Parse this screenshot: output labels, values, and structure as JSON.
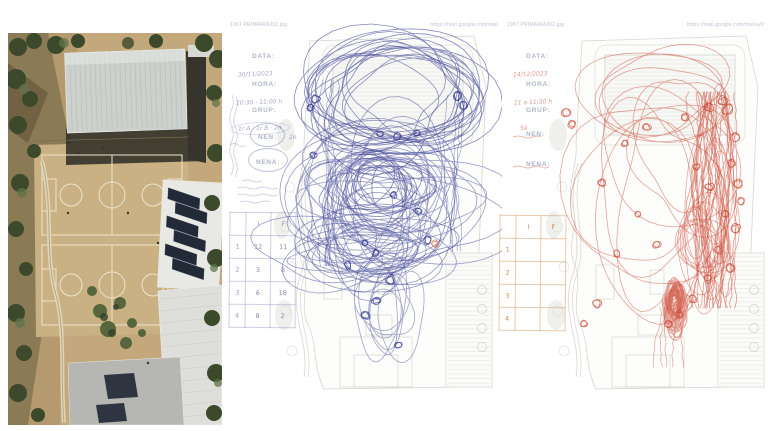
{
  "pages": {
    "blue": {
      "header_left": "1967 PRIMARIA302.jpg",
      "header_right": "https://mail.google.com/mail",
      "ink": "#353b90",
      "form": {
        "data_label": "DATA:",
        "data_value": "30/11/2023",
        "hora_label": "HORA:",
        "hora_value": "10:30 - 11:00 h",
        "grup_label": "GRUP:",
        "grup_value": "1r A · 1r B · 2n",
        "nen_label": "NEN:",
        "nen_value": "2n",
        "nena_label": "NENA:",
        "nena_value": ""
      },
      "table": {
        "col_i": "I",
        "col_f": "F",
        "rows": [
          [
            "1",
            "12",
            "11"
          ],
          [
            "2",
            "3",
            "8"
          ],
          [
            "3",
            "6",
            "18"
          ],
          [
            "4",
            "8",
            "2"
          ]
        ]
      },
      "scribbles": {
        "clusters": [
          {
            "kind": "loops",
            "tight": true,
            "cx": 167,
            "cy": 80,
            "rx": 78,
            "ry": 56,
            "n": 12,
            "w": 0.8,
            "o": 0.6,
            "seed": 7
          },
          {
            "kind": "loops",
            "tight": true,
            "cx": 166,
            "cy": 82,
            "rx": 66,
            "ry": 46,
            "n": 6,
            "w": 0.8,
            "o": 0.55,
            "seed": 8
          },
          {
            "kind": "loops",
            "cx": 147,
            "cy": 185,
            "rx": 80,
            "ry": 62,
            "n": 30,
            "w": 0.8,
            "o": 0.5,
            "seed": 9
          },
          {
            "kind": "loops",
            "cx": 135,
            "cy": 235,
            "rx": 70,
            "ry": 32,
            "n": 14,
            "w": 0.8,
            "o": 0.5,
            "seed": 10
          },
          {
            "kind": "loops",
            "cx": 150,
            "cy": 170,
            "rx": 45,
            "ry": 28,
            "n": 12,
            "w": 0.9,
            "o": 0.55,
            "seed": 11
          },
          {
            "kind": "loops",
            "cx": 162,
            "cy": 302,
            "rx": 28,
            "ry": 45,
            "n": 7,
            "w": 0.8,
            "o": 0.45,
            "seed": 12
          },
          {
            "kind": "strands",
            "cx": 100,
            "cy": 160,
            "rx": 10,
            "ry": 95,
            "n": 5,
            "w": 0.7,
            "o": 0.45,
            "seed": 13
          },
          {
            "kind": "strands",
            "cx": 228,
            "cy": 160,
            "rx": 10,
            "ry": 80,
            "n": 4,
            "w": 0.7,
            "o": 0.45,
            "seed": 14
          },
          {
            "kind": "dots",
            "w": 0.9,
            "o": 0.8,
            "seed": 15,
            "pts": [
              [
                88,
                84,
                4
              ],
              [
                82,
                93,
                3.5
              ],
              [
                229,
                81,
                4
              ],
              [
                235,
                90,
                3.5
              ],
              [
                152,
                119,
                3
              ],
              [
                169,
                121,
                3.5
              ],
              [
                189,
                118,
                3
              ],
              [
                85,
                140,
                3
              ],
              [
                190,
                196,
                3.5
              ],
              [
                137,
                228,
                3
              ],
              [
                120,
                250,
                3.5
              ],
              [
                165,
                180,
                3
              ],
              [
                200,
                225,
                3.5
              ],
              [
                148,
                238,
                3
              ],
              [
                162,
                265,
                4
              ],
              [
                148,
                286,
                3.5
              ],
              [
                138,
                300,
                4
              ],
              [
                170,
                330,
                3
              ]
            ]
          },
          {
            "kind": "dots",
            "color": "#d4693a",
            "w": 0.9,
            "o": 0.7,
            "seed": 16,
            "pts": [
              [
                207,
                229,
                3
              ]
            ]
          }
        ]
      }
    },
    "red": {
      "header_left": "1967 PRIMARIA302.jpg",
      "header_right": "https://mail.google.com/mail/u/0",
      "ink": "#cb4732",
      "form": {
        "data_label": "DATA:",
        "data_value": "14/12/2023",
        "hora_label": "HORA:",
        "hora_value": "11 a 11:30 h",
        "grup_label": "GRUP:",
        "grup_value": "5è",
        "nen_label": "NEN:",
        "nen_value": "",
        "nena_label": "NENA:",
        "nena_value": ""
      },
      "table": {
        "col_i": "I",
        "col_f": "F",
        "rows": [
          [
            "1",
            "",
            ""
          ],
          [
            "2",
            "",
            ""
          ],
          [
            "3",
            "",
            ""
          ],
          [
            "4",
            "",
            ""
          ]
        ]
      },
      "scribbles": {
        "clusters": [
          {
            "kind": "loops",
            "cx": 150,
            "cy": 180,
            "rx": 90,
            "ry": 135,
            "n": 8,
            "w": 0.8,
            "o": 0.5,
            "seed": 21
          },
          {
            "kind": "loops",
            "tight": true,
            "cx": 158,
            "cy": 83,
            "rx": 72,
            "ry": 48,
            "n": 4,
            "w": 0.8,
            "o": 0.5,
            "seed": 22
          },
          {
            "kind": "strands",
            "cx": 207,
            "cy": 185,
            "rx": 20,
            "ry": 108,
            "n": 22,
            "w": 0.8,
            "o": 0.55,
            "seed": 23
          },
          {
            "kind": "loops",
            "cx": 209,
            "cy": 185,
            "rx": 20,
            "ry": 90,
            "n": 10,
            "w": 0.8,
            "o": 0.45,
            "seed": 24
          },
          {
            "kind": "loops",
            "cx": 170,
            "cy": 291,
            "rx": 10,
            "ry": 24,
            "n": 24,
            "w": 1.1,
            "o": 0.5,
            "seed": 25
          },
          {
            "kind": "loops",
            "cx": 170,
            "cy": 284,
            "rx": 6,
            "ry": 13,
            "n": 14,
            "w": 1.2,
            "o": 0.55,
            "seed": 26
          },
          {
            "kind": "loops",
            "cx": 196,
            "cy": 235,
            "rx": 26,
            "ry": 42,
            "n": 8,
            "w": 0.8,
            "o": 0.45,
            "seed": 27
          },
          {
            "kind": "strands",
            "cx": 162,
            "cy": 322,
            "rx": 14,
            "ry": 30,
            "n": 5,
            "w": 0.8,
            "o": 0.45,
            "seed": 28
          },
          {
            "kind": "dots",
            "w": 0.9,
            "o": 0.75,
            "seed": 29,
            "pts": [
              [
                62,
                98,
                4
              ],
              [
                67,
                109,
                3.5
              ],
              [
                97,
                168,
                3.5
              ],
              [
                120,
                128,
                3
              ],
              [
                142,
                112,
                3.5
              ],
              [
                180,
                102,
                3.5
              ],
              [
                204,
                92,
                4
              ],
              [
                217,
                86,
                4
              ],
              [
                223,
                95,
                4.5
              ],
              [
                226,
                148,
                4
              ],
              [
                233,
                168,
                4
              ],
              [
                220,
                199,
                3.5
              ],
              [
                231,
                213,
                4
              ],
              [
                213,
                235,
                3.5
              ],
              [
                225,
                253,
                4
              ],
              [
                203,
                263,
                3.5
              ],
              [
                188,
                284,
                3.5
              ],
              [
                152,
                229,
                3
              ],
              [
                133,
                199,
                3
              ],
              [
                112,
                239,
                3.5
              ],
              [
                92,
                289,
                3.5
              ],
              [
                79,
                309,
                3
              ],
              [
                163,
                309,
                3.5
              ],
              [
                175,
                300,
                3
              ],
              [
                230,
                122,
                4
              ],
              [
                236,
                186,
                3.5
              ],
              [
                204,
                172,
                3.5
              ],
              [
                192,
                152,
                3
              ]
            ]
          }
        ]
      }
    }
  }
}
